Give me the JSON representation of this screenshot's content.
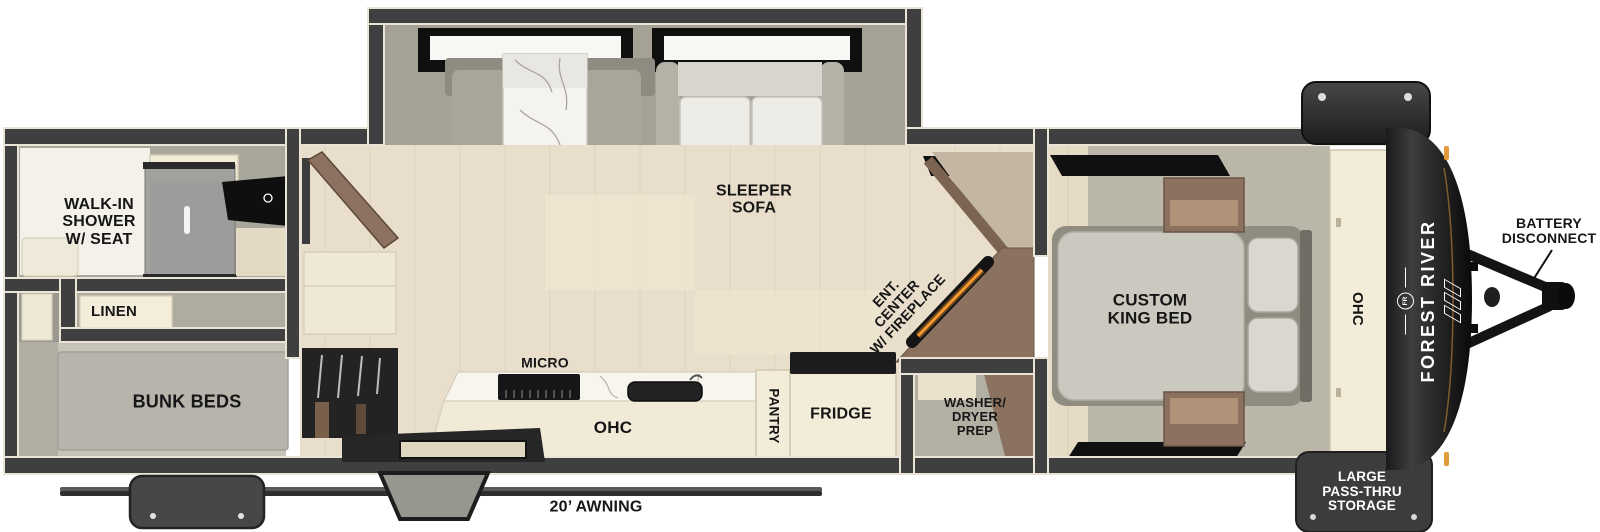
{
  "floorplan": {
    "title": "Travel trailer floor plan",
    "brand": "FOREST RIVER",
    "brand_emblem": "FR",
    "labels": {
      "walk_in_shower": "WALK-IN\nSHOWER\nW/ SEAT",
      "linen": "LINEN",
      "bunk_beds": "BUNK BEDS",
      "sleeper_sofa": "SLEEPER\nSOFA",
      "ent_center": "ENT.\nCENTER\nW/ FIREPLACE",
      "micro": "MICRO",
      "kitchen_ohc": "OHC",
      "pantry": "PANTRY",
      "fridge": "FRIDGE",
      "washer_dryer": "WASHER/\nDRYER\nPREP",
      "custom_king_bed": "CUSTOM\nKING BED",
      "bedroom_ohc": "OHC",
      "battery_disconnect": "BATTERY\nDISCONNECT",
      "pass_thru_storage": "LARGE\nPASS-THRU\nSTORAGE",
      "awning": "20’ AWNING"
    },
    "icons": {
      "faucet": "✳"
    },
    "colors": {
      "wall": "#3f3f3f",
      "wall_outline": "#e9e4d5",
      "floor": "#e8decb",
      "cabinet_cream": "#f3ecd8",
      "wood_brown": "#8b7160",
      "fireplace_orange": "#ff9d33",
      "accent_orange": "#e39a38",
      "label_text": "#161616"
    }
  }
}
